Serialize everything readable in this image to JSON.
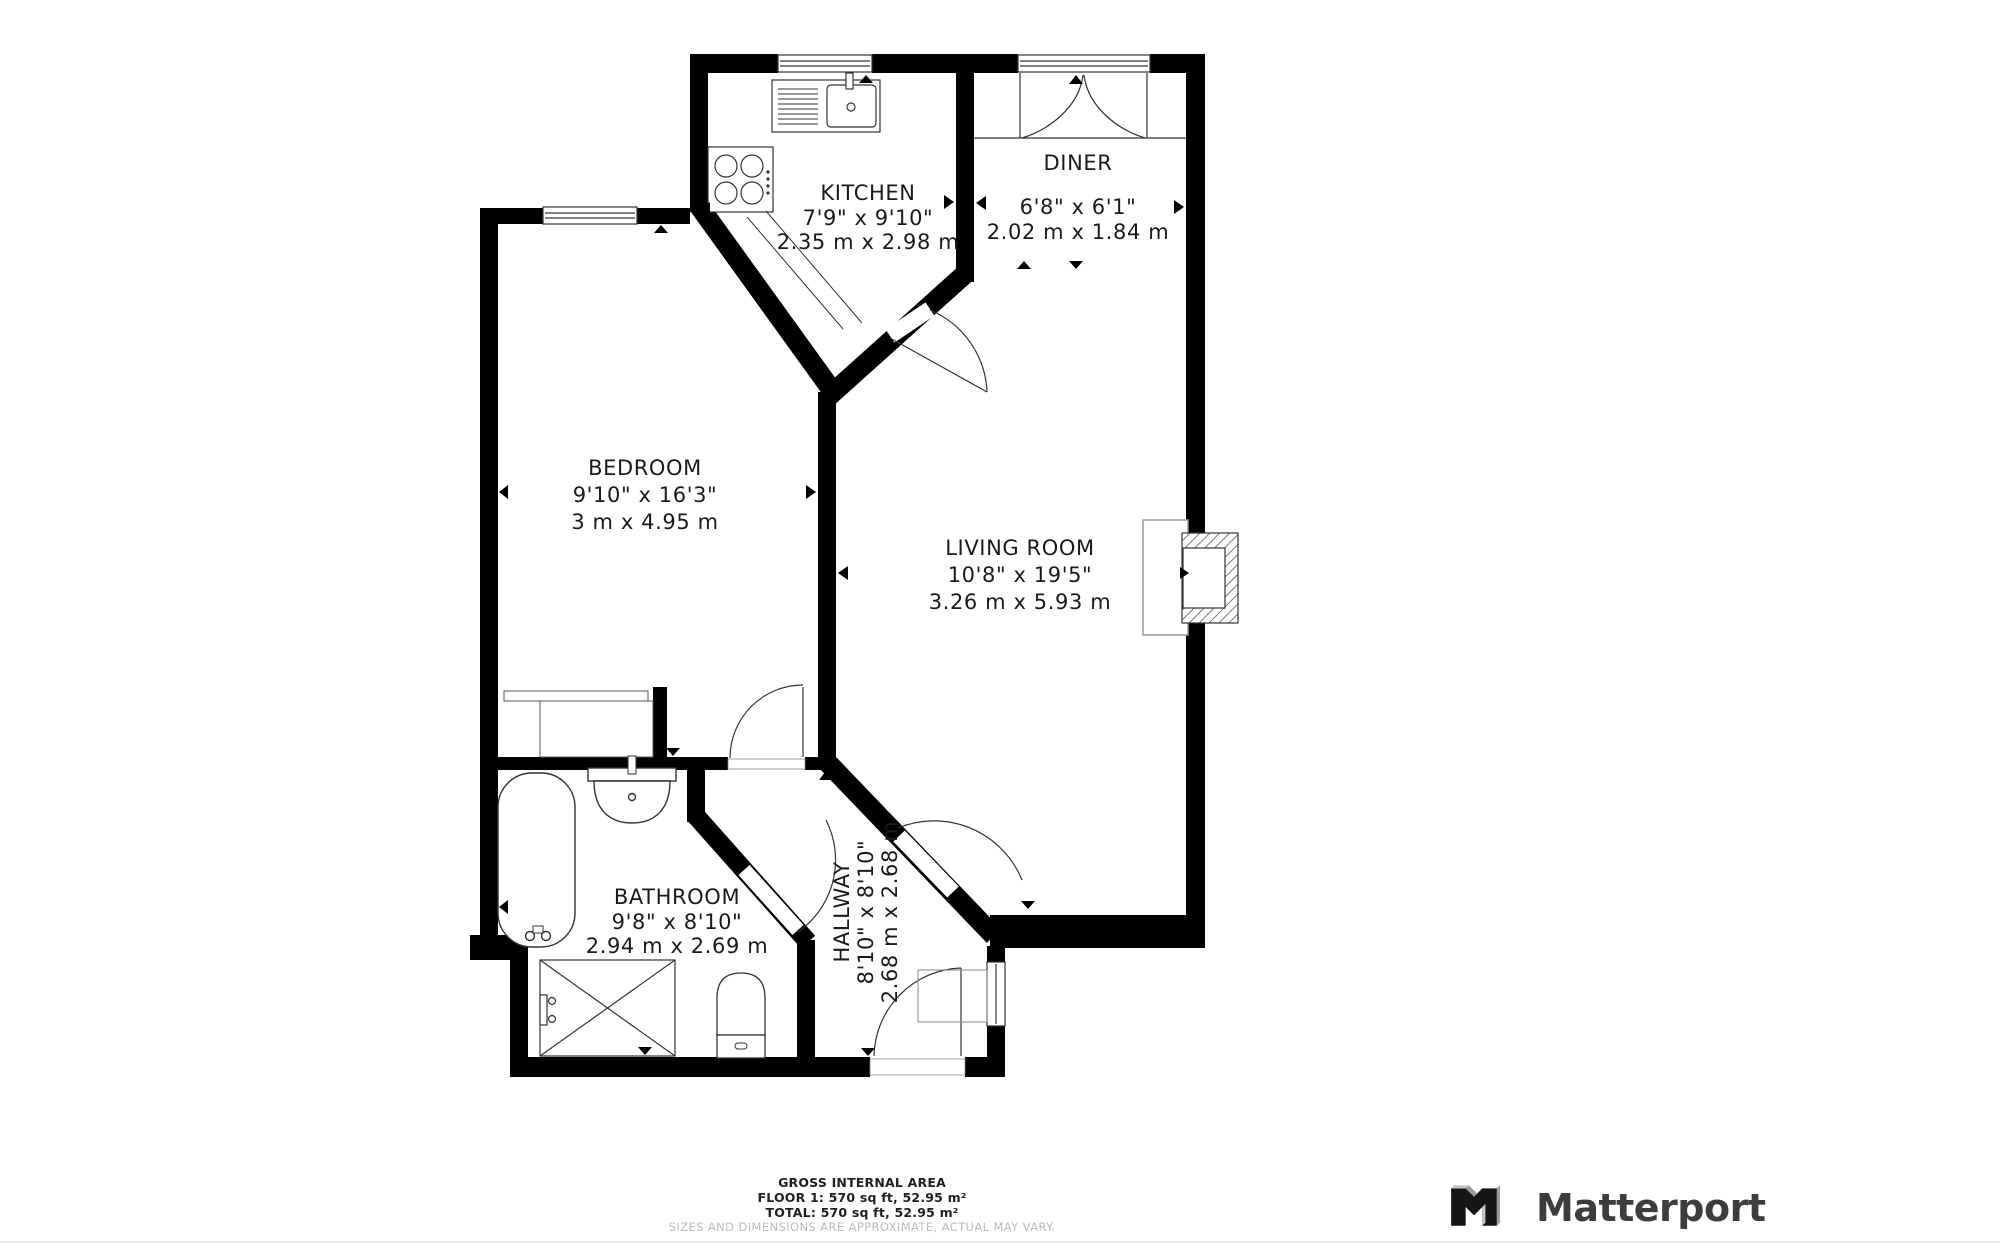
{
  "colors": {
    "wall": "#000000",
    "fixture_line": "#333333",
    "text": "#1a1a1a",
    "muted_text": "#bcbcbc",
    "logo": "#3d3d3d"
  },
  "rooms": [
    {
      "id": "kitchen",
      "name": "KITCHEN",
      "imperial": "7'9\" x 9'10\"",
      "metric": "2.35 m x 2.98 m"
    },
    {
      "id": "diner",
      "name": "DINER",
      "imperial": "6'8\" x 6'1\"",
      "metric": "2.02 m x 1.84 m"
    },
    {
      "id": "bedroom",
      "name": "BEDROOM",
      "imperial": "9'10\" x 16'3\"",
      "metric": "3 m x 4.95 m"
    },
    {
      "id": "living_room",
      "name": "LIVING ROOM",
      "imperial": "10'8\" x 19'5\"",
      "metric": "3.26 m x 5.93 m"
    },
    {
      "id": "bathroom",
      "name": "BATHROOM",
      "imperial": "9'8\" x 8'10\"",
      "metric": "2.94 m x 2.69 m"
    },
    {
      "id": "hallway",
      "name": "HALLWAY",
      "imperial": "8'10\" x 8'10\"",
      "metric": "2.68 m x 2.68 m"
    }
  ],
  "footer": {
    "title": "GROSS INTERNAL AREA",
    "floor_line": "FLOOR 1: 570 sq ft, 52.95 m²",
    "total_line": "TOTAL: 570 sq ft, 52.95 m²",
    "disclaimer": "SIZES AND DIMENSIONS ARE APPROXIMATE, ACTUAL MAY VARY."
  },
  "branding": {
    "logo_text": "Matterport"
  }
}
